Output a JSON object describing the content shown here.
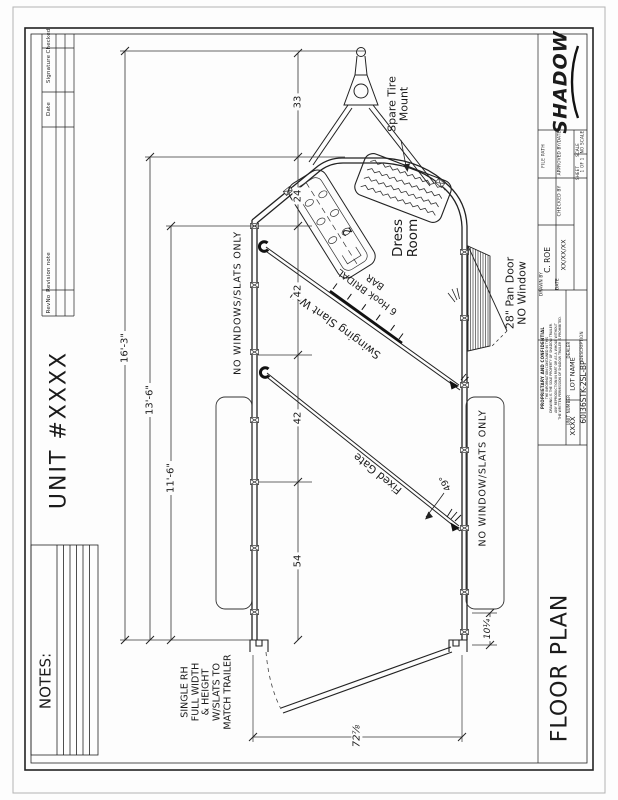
{
  "sheet": {
    "unit_title": "UNIT #XXXX",
    "notes_label": "NOTES:",
    "view_title": "FLOOR PLAN"
  },
  "revision_table": {
    "headers": [
      "Checked",
      "Signature",
      "Date",
      "Revision note",
      "RevNo"
    ]
  },
  "title_block": {
    "logo": "SHADOW",
    "file_path_label": "FILE PATH",
    "approved_label": "APPROVED BY/DATE",
    "checked_label": "CHECKED BY",
    "scale_label": "SCALE",
    "scale_value": "NO SCALE",
    "sheet_label": "SHEET",
    "sheet_value": "1 OF 1",
    "drawn_by_label": "DRAWN BY",
    "drawn_by_value": "C. ROE",
    "date_label": "DATE",
    "date_value": "XX/XX/XX",
    "proprietary_title": "PROPRIETARY AND CONFIDENTIAL",
    "proprietary_lines": [
      "THE INFORMATION CONTAINED IN THIS",
      "DRAWING IS THE SOLE PROPERTY OF SHADOW TRAILER.",
      "ANY REPRODUCTION IN PART OR AS A WHOLE WITHOUT",
      "THE WRITTEN PERMISSION OF SHADOW TRAILER IS PROHIBITED."
    ],
    "description_label": "DESCRIPTION",
    "description_value": "60I36STK-2SL-BP",
    "unit_number_label": "UNIT NUMBER",
    "unit_number_value": "XXXX",
    "dealer_label": "DEALER",
    "dealer_value": "LOT NAME"
  },
  "plan": {
    "labels": {
      "spare_tire": [
        "Spare Tire",
        "Mount"
      ],
      "dress_room": [
        "Dress",
        "Room"
      ],
      "pan_door": [
        "28\" Pan Door",
        "NO Window"
      ],
      "left_wall_note": "NO WINDOWS/SLATS ONLY",
      "right_wall_note": "NO WINDOW/SLATS ONLY",
      "slant_wall": "Swinging Slant Wall",
      "bridal_bar": [
        "6 Hook BRIDAL",
        "BAR"
      ],
      "fixed_gate": "Fixed Gate",
      "rear_door_note": [
        "SINGLE RH",
        "FULL WIDTH",
        "& HEIGHT",
        "W/SLATS TO",
        "MATCH TRAILER"
      ],
      "saddle_rack_count": "2"
    },
    "dimensions": {
      "overall_length": "16'-3\"",
      "box_length": "13'-6\"",
      "interior_length": "11'-6\"",
      "tongue_length": "33",
      "nose_depth": "24",
      "bay1": "42",
      "bay2": "42",
      "bay3": "54",
      "rear_opening": "72⅞",
      "rear_offset": "10¼",
      "gate_angle": "49°"
    }
  }
}
